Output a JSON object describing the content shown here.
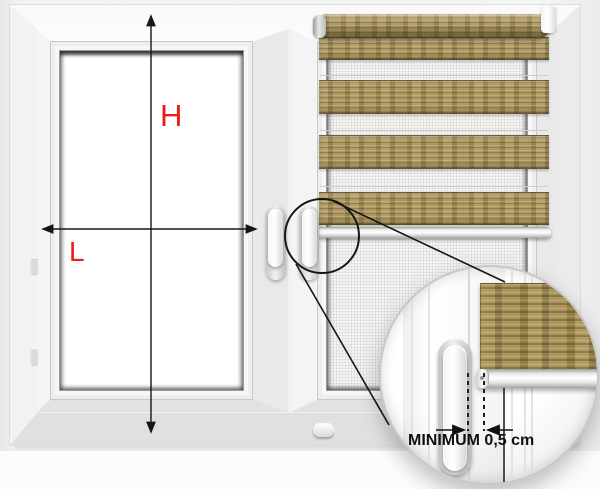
{
  "labels": {
    "height": "H",
    "width": "L"
  },
  "inset": {
    "caption": "MINIMUM 0,5 cm"
  },
  "colors": {
    "measure_label_red": "#ee1b17",
    "annotation_black": "#161616",
    "blind_fabric_tan": "#a6905a",
    "blind_fabric_shadow": "#4c421e",
    "frame_white": "#f7f7f7",
    "sill_gray": "#c2c2c2"
  }
}
